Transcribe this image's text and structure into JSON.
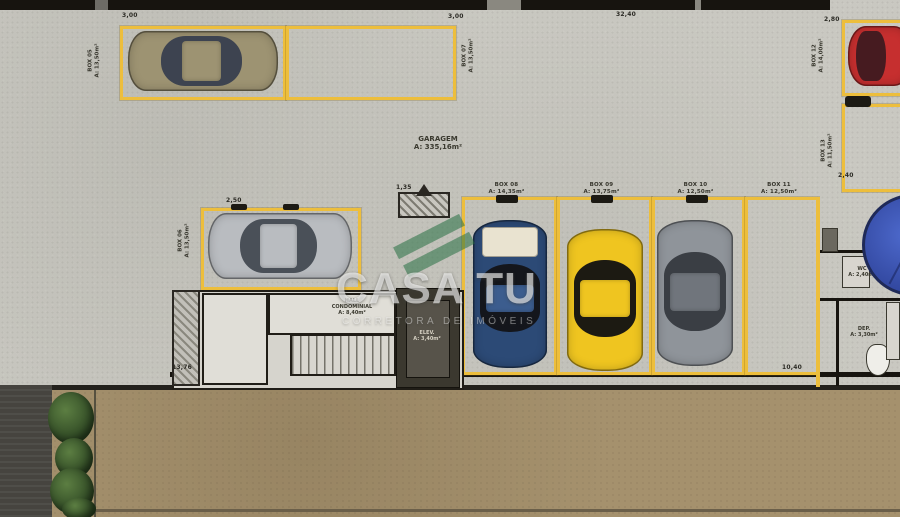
{
  "watermark": {
    "title": "CASA TU",
    "subtitle": "CORRETORA DE IMÓVEIS"
  },
  "garage": {
    "name": "GARAGEM",
    "area": "A: 335,16m²"
  },
  "boxes": [
    {
      "label": "BOX 05",
      "area": "A: 13,50m²"
    },
    {
      "label": "BOX 06",
      "area": "A: 13,50m²"
    },
    {
      "label": "BOX 07",
      "area": "A: 13,50m²"
    },
    {
      "label": "BOX 08",
      "area": "A: 14,35m²"
    },
    {
      "label": "BOX 09",
      "area": "A: 13,75m²"
    },
    {
      "label": "BOX 10",
      "area": "A: 12,50m²"
    },
    {
      "label": "BOX 11",
      "area": "A: 12,50m²"
    },
    {
      "label": "BOX 12",
      "area": "A: 14,00m²"
    },
    {
      "label": "BOX 13",
      "area": "A: 11,50m²"
    }
  ],
  "rooms": {
    "hall": {
      "l1": "HALL",
      "l2": "CONDOMINIAL",
      "l3": "A: 8,40m²"
    },
    "elevator": {
      "l1": "ELEV.",
      "l2": "A: 3,40m²"
    },
    "wc": {
      "l1": "WC",
      "l2": "A: 2,40m²"
    },
    "deposit": {
      "l1": "DEP.",
      "l2": "A: 3,30m²"
    }
  },
  "dimensions": {
    "top_left": "3,00",
    "top_mid": "3,00",
    "top_span": "32,40",
    "top_right": "2,80",
    "box06_top": "2,50",
    "box13_bottom": "2,40",
    "core_top": "1,35",
    "bottom_left": "13,76",
    "bottom_right": "10,40"
  },
  "colors": {
    "box_line": "#edbe3c",
    "floor_concrete": "#c9c8c1",
    "driveway_tan": "#a5916d",
    "wall_black": "#17140f",
    "car_olive": "#9d9372",
    "car_silver": "#b9bcc0",
    "car_blue": "#2c4a76",
    "car_yellow": "#efc520",
    "car_gray": "#8f949a",
    "car_red": "#c62f2f",
    "pool_blue": "#4d69cc",
    "plant_green": "#2c4522",
    "logo_green": "#267042"
  }
}
